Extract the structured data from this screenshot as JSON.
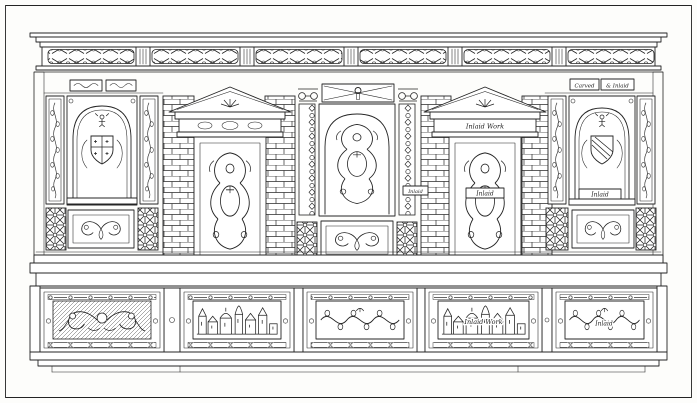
{
  "plate": {
    "type": "line-engraving",
    "subject": "carved-and-inlaid-sideboard",
    "ink_color": "#242424",
    "paper_color": "#fdfdfb"
  },
  "labels": {
    "carved": "Carved",
    "and_inlaid": "& Inlaid",
    "inlaid_work": "Inlaid Work",
    "inlaid": "Inlaid"
  },
  "drawer_motifs": [
    "carved-grotesques",
    "inlaid-townscape",
    "carved-foliage-birds",
    "inlaid-townscape-labelled",
    "inlaid-foliage-labelled"
  ]
}
